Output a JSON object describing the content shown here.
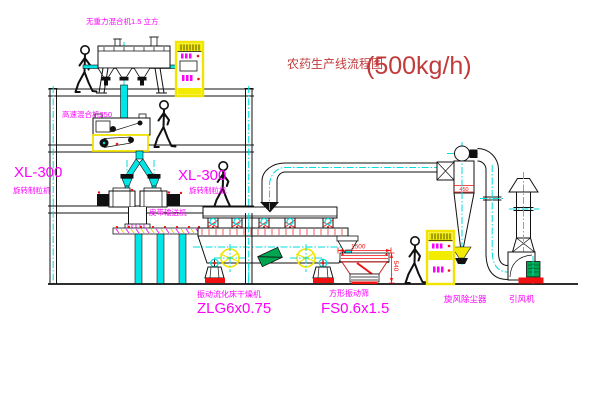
{
  "title": {
    "name": "农药生产线流程图",
    "capacity": "(500kg/h)"
  },
  "equipment": {
    "gravity_mixer": {
      "label": "无重力混合机1.5 立方"
    },
    "high_speed_mixer": {
      "label": "高速混合机350"
    },
    "granulator_left": {
      "model": "XL-300",
      "name": "旋转制粒机"
    },
    "granulator_right": {
      "model": "XL-300",
      "name": "旋转制粒机"
    },
    "belt_conveyor": {
      "name": "皮带输送机"
    },
    "fluid_bed_dryer": {
      "name": "振动流化床干燥机",
      "model": "ZLG6x0.75"
    },
    "vibrating_sieve": {
      "name": "方形振动筛",
      "model": "FS0.6x1.5",
      "dim_length": "1500",
      "dim_height": "540"
    },
    "cyclone": {
      "name": "旋风除尘器",
      "dim": "450"
    },
    "induced_draft_fan": {
      "name": "引风机"
    }
  },
  "colors": {
    "centerline_cyan": "#00dede",
    "label_magenta": "#ff00ff",
    "dimension_red": "#f21111",
    "title_red": "#c23b3b",
    "cabinet_yellow": "#f4ec00",
    "machine_green": "#00a550"
  }
}
